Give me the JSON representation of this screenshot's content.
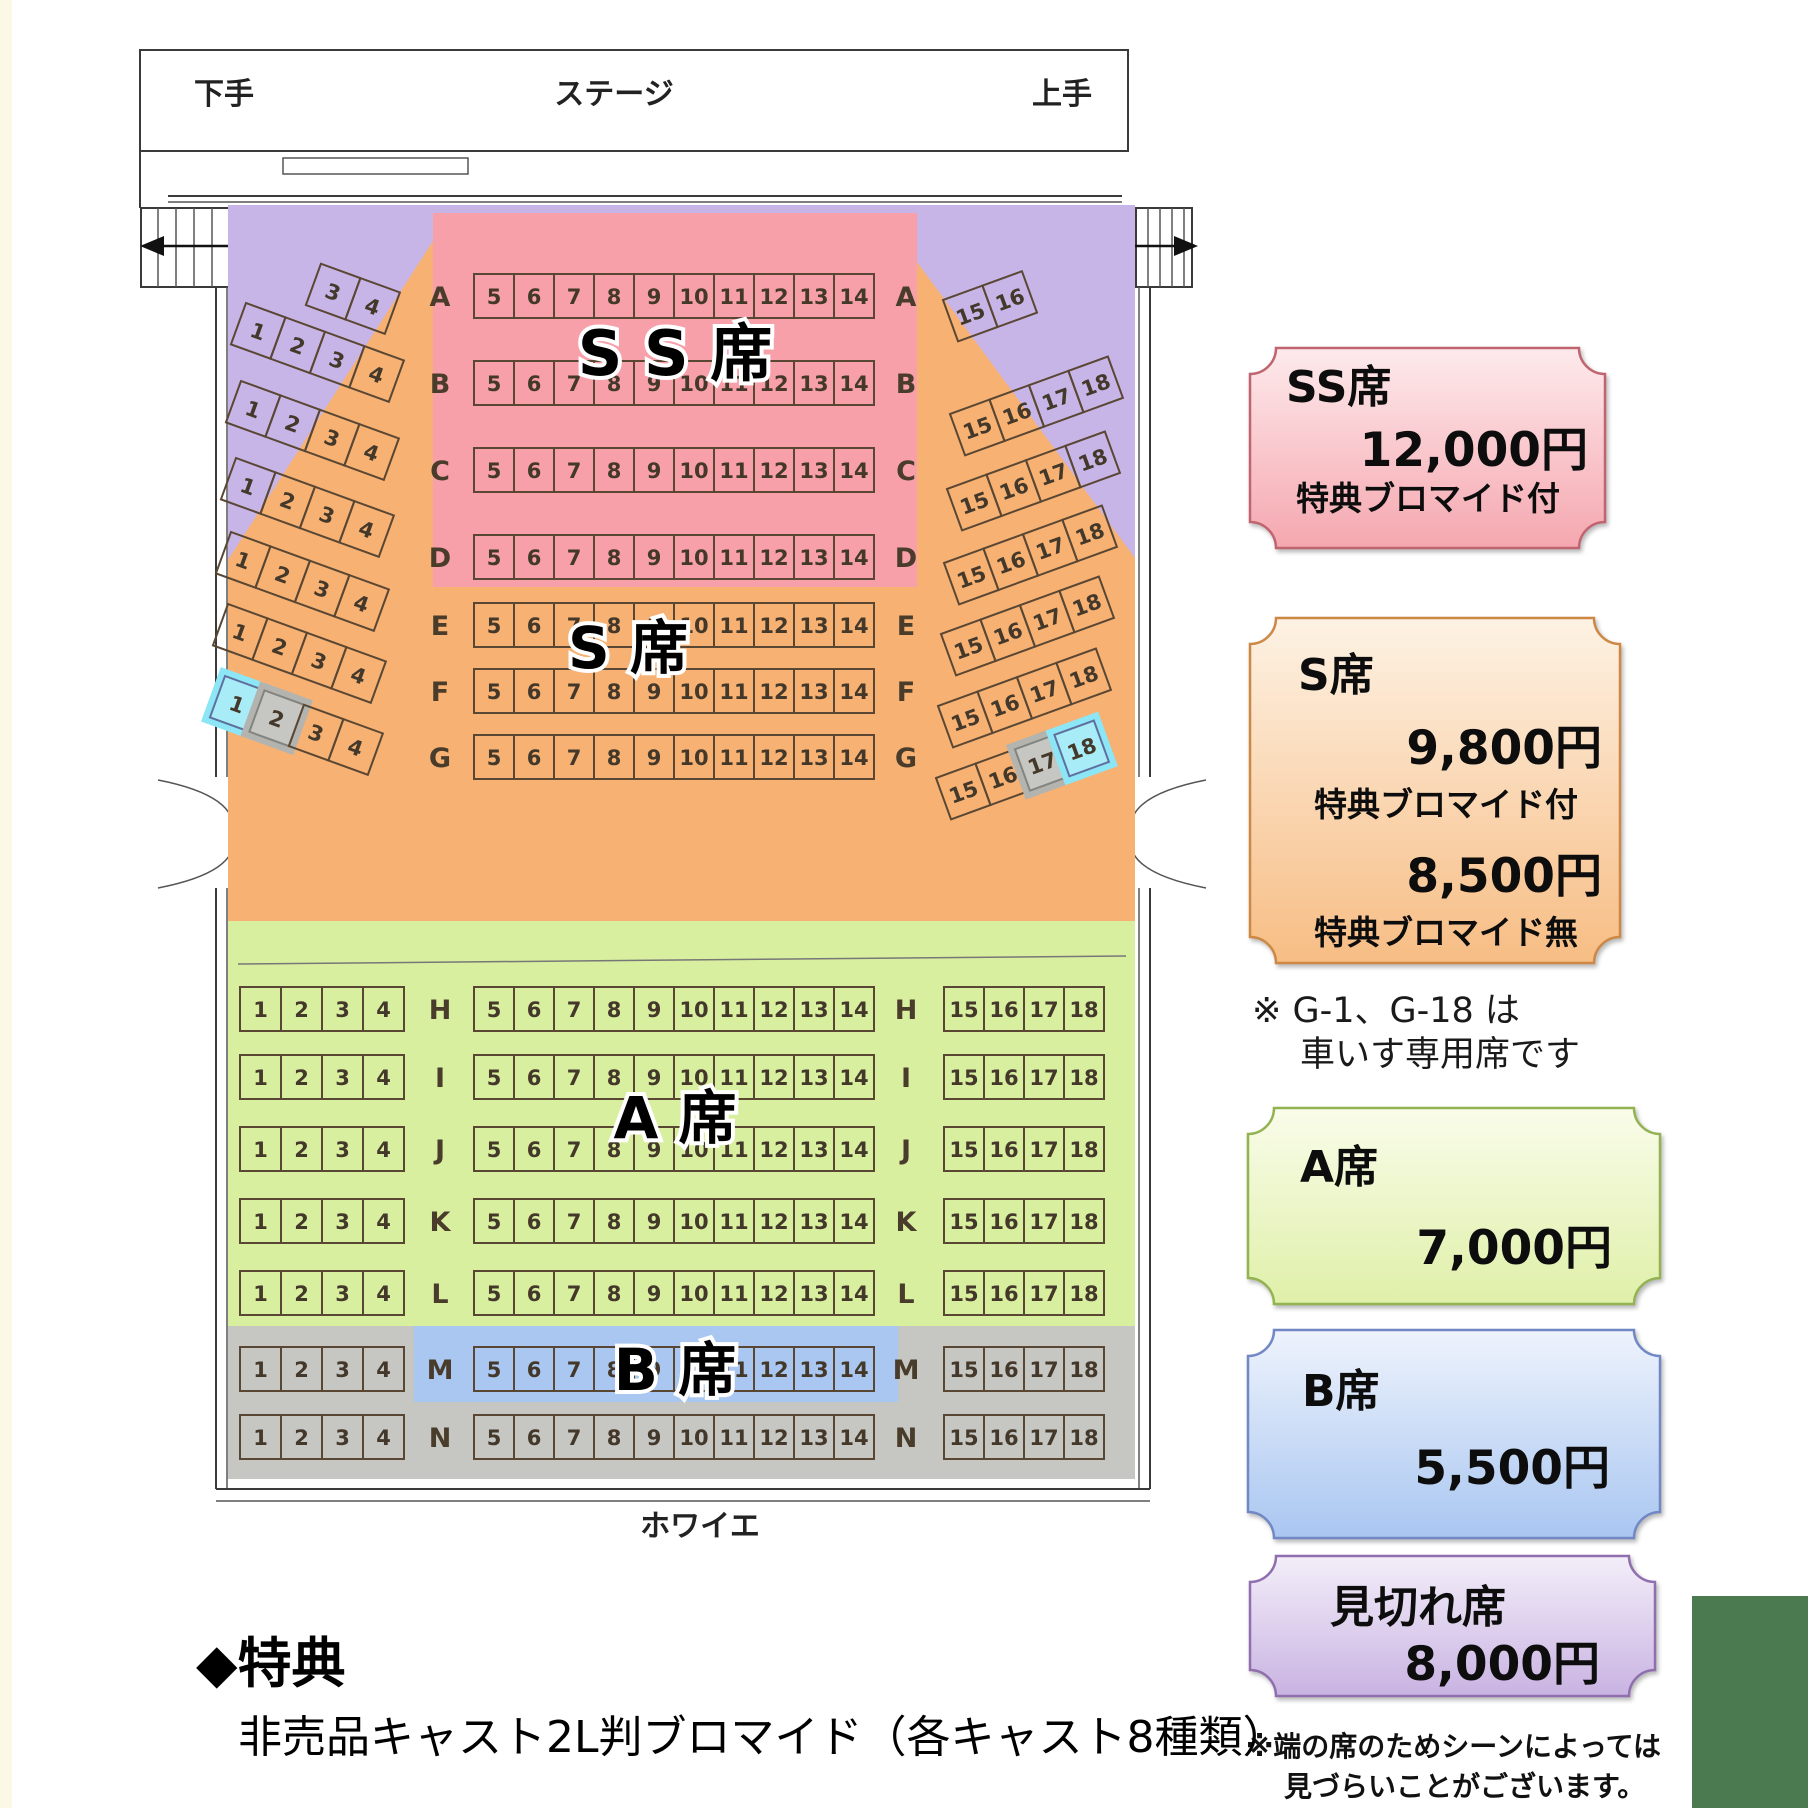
{
  "colors": {
    "purple": "#c7b5e8",
    "pink": "#f7a0a9",
    "orange": "#f6b173",
    "green": "#d9efa0",
    "blue": "#a9c7f0",
    "gray": "#c6c6c2",
    "cyan": "#8ce6f6",
    "cyan_seat": "#a8ecf8",
    "gray_seat": "#c6c6c2",
    "green_block_br": "#4c7a50",
    "ticket_ss_top": "#fdeaec",
    "ticket_ss_bottom": "#f5a7af",
    "ticket_ss_border": "#c06570",
    "ticket_s_top": "#fdf2e4",
    "ticket_s_bottom": "#f7bd84",
    "ticket_s_border": "#cc8844",
    "ticket_a_top": "#f9fcea",
    "ticket_a_bottom": "#dff0a8",
    "ticket_a_border": "#93b353",
    "ticket_b_top": "#eef3fc",
    "ticket_b_bottom": "#a9c6f1",
    "ticket_b_border": "#7188c4",
    "ticket_mikire_top": "#f3eef9",
    "ticket_mikire_bottom": "#c9b3e2",
    "ticket_mikire_border": "#8f6fae"
  },
  "stage": {
    "center_label": "ステージ",
    "left_label": "下手",
    "right_label": "上手"
  },
  "foyer_label": "ホワイエ",
  "zone_labels": {
    "ss": "S S 席",
    "s": "S 席",
    "a": "A 席",
    "b": "B 席"
  },
  "rows": [
    {
      "id": "A",
      "fan": true,
      "left": [
        3,
        4
      ],
      "center": [
        5,
        6,
        7,
        8,
        9,
        10,
        11,
        12,
        13,
        14
      ],
      "right": [
        15,
        16
      ]
    },
    {
      "id": "B",
      "fan": true,
      "left": [
        1,
        2,
        3,
        4
      ],
      "center": [
        5,
        6,
        7,
        8,
        9,
        10,
        11,
        12,
        13,
        14
      ],
      "right": [
        15,
        16,
        17,
        18
      ]
    },
    {
      "id": "C",
      "fan": true,
      "left": [
        1,
        2,
        3,
        4
      ],
      "center": [
        5,
        6,
        7,
        8,
        9,
        10,
        11,
        12,
        13,
        14
      ],
      "right": [
        15,
        16,
        17,
        18
      ]
    },
    {
      "id": "D",
      "fan": true,
      "left": [
        1,
        2,
        3,
        4
      ],
      "center": [
        5,
        6,
        7,
        8,
        9,
        10,
        11,
        12,
        13,
        14
      ],
      "right": [
        15,
        16,
        17,
        18
      ]
    },
    {
      "id": "E",
      "fan": true,
      "left": [
        1,
        2,
        3,
        4
      ],
      "center": [
        5,
        6,
        7,
        8,
        9,
        10,
        11,
        12,
        13,
        14
      ],
      "right": [
        15,
        16,
        17,
        18
      ]
    },
    {
      "id": "F",
      "fan": true,
      "left": [
        1,
        2,
        3,
        4
      ],
      "center": [
        5,
        6,
        7,
        8,
        9,
        10,
        11,
        12,
        13,
        14
      ],
      "right": [
        15,
        16,
        17,
        18
      ]
    },
    {
      "id": "G",
      "fan": true,
      "left": [
        1,
        2,
        3,
        4
      ],
      "center": [
        5,
        6,
        7,
        8,
        9,
        10,
        11,
        12,
        13,
        14
      ],
      "right": [
        15,
        16,
        17,
        18
      ]
    },
    {
      "id": "H",
      "fan": false,
      "left": [
        1,
        2,
        3,
        4
      ],
      "center": [
        5,
        6,
        7,
        8,
        9,
        10,
        11,
        12,
        13,
        14
      ],
      "right": [
        15,
        16,
        17,
        18
      ]
    },
    {
      "id": "I",
      "fan": false,
      "left": [
        1,
        2,
        3,
        4
      ],
      "center": [
        5,
        6,
        7,
        8,
        9,
        10,
        11,
        12,
        13,
        14
      ],
      "right": [
        15,
        16,
        17,
        18
      ]
    },
    {
      "id": "J",
      "fan": false,
      "left": [
        1,
        2,
        3,
        4
      ],
      "center": [
        5,
        6,
        7,
        8,
        9,
        10,
        11,
        12,
        13,
        14
      ],
      "right": [
        15,
        16,
        17,
        18
      ]
    },
    {
      "id": "K",
      "fan": false,
      "left": [
        1,
        2,
        3,
        4
      ],
      "center": [
        5,
        6,
        7,
        8,
        9,
        10,
        11,
        12,
        13,
        14
      ],
      "right": [
        15,
        16,
        17,
        18
      ]
    },
    {
      "id": "L",
      "fan": false,
      "left": [
        1,
        2,
        3,
        4
      ],
      "center": [
        5,
        6,
        7,
        8,
        9,
        10,
        11,
        12,
        13,
        14
      ],
      "right": [
        15,
        16,
        17,
        18
      ]
    },
    {
      "id": "M",
      "fan": false,
      "left": [
        1,
        2,
        3,
        4
      ],
      "center": [
        5,
        6,
        7,
        8,
        9,
        10,
        11,
        12,
        13,
        14
      ],
      "right": [
        15,
        16,
        17,
        18
      ]
    },
    {
      "id": "N",
      "fan": false,
      "left": [
        1,
        2,
        3,
        4
      ],
      "center": [
        5,
        6,
        7,
        8,
        9,
        10,
        11,
        12,
        13,
        14
      ],
      "right": [
        15,
        16,
        17,
        18
      ]
    }
  ],
  "special_seats": {
    "wheelchair": [
      "G-1",
      "G-18"
    ],
    "gray": [
      "G-2",
      "G-17"
    ]
  },
  "tickets": [
    {
      "id": "ss",
      "title": "SS席",
      "price": "12,000円",
      "note": "特典ブロマイド付"
    },
    {
      "id": "s",
      "title": "S席",
      "price": "9,800円",
      "note": "特典ブロマイド付",
      "price2": "8,500円",
      "note2": "特典ブロマイド無"
    },
    {
      "id": "a",
      "title": "A席",
      "price": "7,000円"
    },
    {
      "id": "b",
      "title": "B席",
      "price": "5,500円"
    },
    {
      "id": "mikire",
      "title": "見切れ席",
      "price": "8,000円"
    }
  ],
  "notes": {
    "wheelchair_line1": "※ G-1、G-18 は",
    "wheelchair_line2": "車いす専用席です",
    "edge_line1": "※端の席のためシーンによっては",
    "edge_line2": "見づらいことがございます。"
  },
  "benefits": {
    "heading": "◆特典",
    "body": "非売品キャスト2L判ブロマイド（各キャスト8種類）"
  }
}
